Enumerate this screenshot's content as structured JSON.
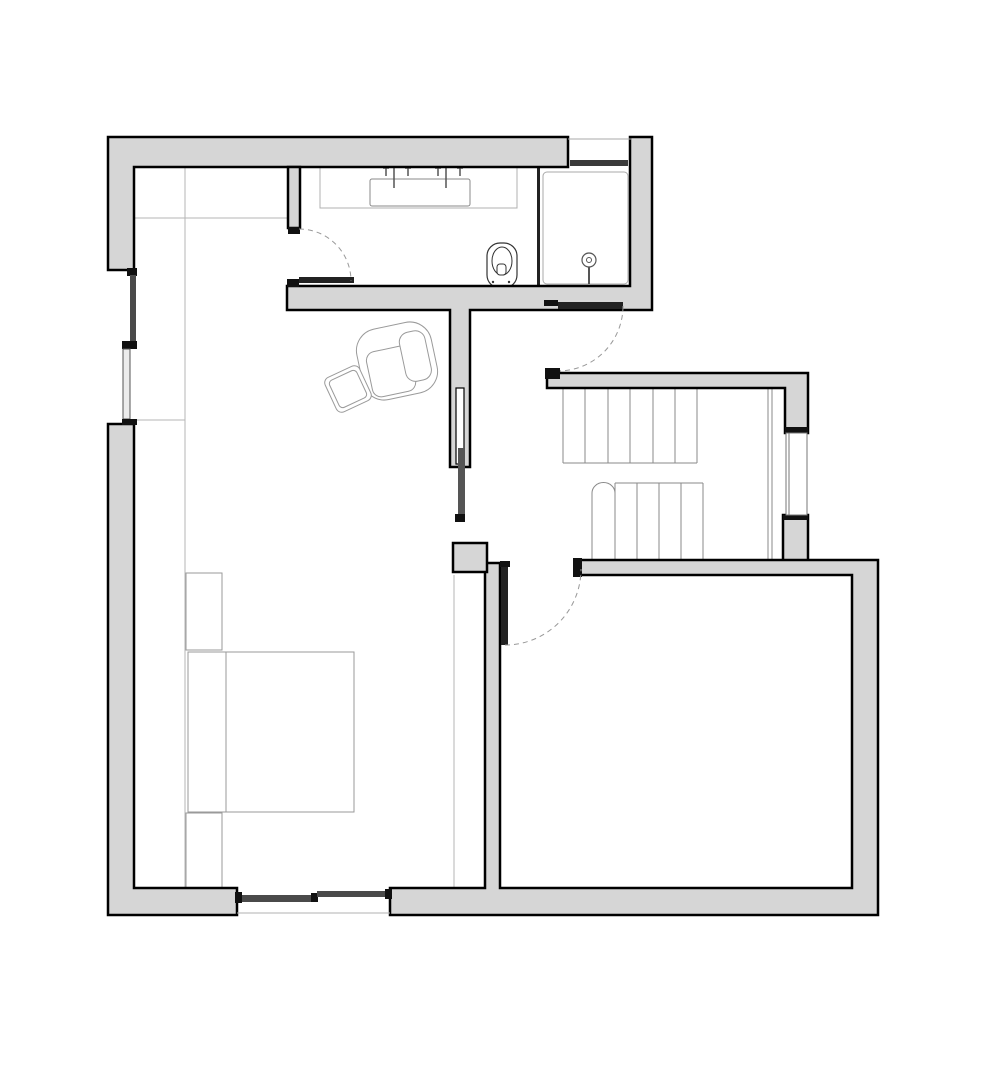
{
  "document": {
    "kind": "architectural-floor-plan",
    "canvas": {
      "width": 1000,
      "height": 1079,
      "background": "#ffffff"
    }
  },
  "colors": {
    "wall_fill": "#d6d6d6",
    "wall_stroke": "#000000",
    "black_detail": "#111111",
    "door_leaf": "#222222",
    "panel_dark": "#4a4a4a",
    "panel_light": "#ececec",
    "fixture_stroke": "#555555",
    "stair_stroke": "#8a8a8a",
    "furniture_stroke": "#9a9a9a",
    "faint_line": "#b5b5b5",
    "arc_dash": "#999999",
    "window_bar": "#3a3a3a"
  },
  "layers": [
    {
      "name": "furniture",
      "items": [
        {
          "type": "line",
          "name": "closet-top-line",
          "x1": 134,
          "y1": 218,
          "x2": 288,
          "y2": 218,
          "stroke": "#b5b5b5",
          "sw": 1
        },
        {
          "type": "line",
          "name": "closet-side-line",
          "x1": 185,
          "y1": 167,
          "x2": 185,
          "y2": 888,
          "stroke": "#b5b5b5",
          "sw": 1
        },
        {
          "type": "line",
          "name": "closet-divider-line",
          "x1": 134,
          "y1": 420,
          "x2": 185,
          "y2": 420,
          "stroke": "#b5b5b5",
          "sw": 1
        },
        {
          "type": "line",
          "name": "wardrobe-edge-line",
          "x1": 454,
          "y1": 575,
          "x2": 454,
          "y2": 888,
          "stroke": "#b5b5b5",
          "sw": 1
        },
        {
          "type": "rect",
          "name": "vanity-counter",
          "x": 320,
          "y": 166,
          "w": 197,
          "h": 42,
          "fill": "none",
          "stroke": "#b0b0b0",
          "sw": 1
        },
        {
          "type": "rect",
          "name": "nightstand-top",
          "x": 186,
          "y": 573,
          "w": 36,
          "h": 77,
          "fill": "#ffffff",
          "stroke": "#9a9a9a",
          "sw": 1
        },
        {
          "type": "rect",
          "name": "nightstand-bottom",
          "x": 186,
          "y": 813,
          "w": 36,
          "h": 75,
          "fill": "#ffffff",
          "stroke": "#9a9a9a",
          "sw": 1
        },
        {
          "type": "rect",
          "name": "bed",
          "x": 188,
          "y": 652,
          "w": 166,
          "h": 160,
          "fill": "#ffffff",
          "stroke": "#9a9a9a",
          "sw": 1
        },
        {
          "type": "line",
          "name": "bed-headboard-line",
          "x1": 226,
          "y1": 652,
          "x2": 226,
          "y2": 812,
          "stroke": "#9a9a9a",
          "sw": 1
        },
        {
          "type": "group",
          "name": "armchair",
          "transform": "translate(397,361) rotate(-12)",
          "items": [
            {
              "type": "rect",
              "name": "armchair-shell",
              "x": -38,
              "y": -36,
              "w": 76,
              "h": 72,
              "rx": 22,
              "fill": "#ffffff",
              "stroke": "#9a9a9a",
              "sw": 1
            },
            {
              "type": "rect",
              "name": "armchair-seat",
              "x": -30,
              "y": -14,
              "w": 44,
              "h": 46,
              "rx": 9,
              "fill": "#ffffff",
              "stroke": "#9a9a9a",
              "sw": 1
            },
            {
              "type": "rect",
              "name": "armchair-back",
              "x": 6,
              "y": -26,
              "w": 26,
              "h": 50,
              "rx": 10,
              "fill": "#ffffff",
              "stroke": "#9a9a9a",
              "sw": 1
            }
          ]
        },
        {
          "type": "group",
          "name": "ottoman",
          "transform": "translate(348,389) rotate(-25)",
          "items": [
            {
              "type": "rect",
              "name": "ottoman-outer",
              "x": -19,
              "y": -19,
              "w": 38,
              "h": 38,
              "rx": 6,
              "fill": "#ffffff",
              "stroke": "#9a9a9a",
              "sw": 1
            },
            {
              "type": "rect",
              "name": "ottoman-inner",
              "x": -15,
              "y": -15,
              "w": 30,
              "h": 30,
              "rx": 4,
              "fill": "none",
              "stroke": "#9a9a9a",
              "sw": 1
            }
          ]
        }
      ]
    },
    {
      "name": "fixtures",
      "items": [
        {
          "type": "rect",
          "name": "sink-basin",
          "x": 370,
          "y": 179,
          "w": 100,
          "h": 27,
          "rx": 2,
          "fill": "#ffffff",
          "stroke": "#888888",
          "sw": 1
        },
        {
          "type": "path",
          "name": "faucet-left",
          "d": "M383,168 h6 M386,168 v8 M405,168 h6 M408,168 v8 M394,167 v21",
          "stroke": "#555555",
          "sw": 1.5,
          "fill": "none"
        },
        {
          "type": "path",
          "name": "faucet-right",
          "d": "M435,168 h6 M438,168 v8 M457,168 h6 M460,168 v8 M446,167 v21",
          "stroke": "#555555",
          "sw": 1.5,
          "fill": "none"
        },
        {
          "type": "rect",
          "name": "toilet-bowl",
          "x": 487,
          "y": 243,
          "w": 30,
          "h": 45,
          "rx": 13,
          "fill": "#ffffff",
          "stroke": "#333333",
          "sw": 1.2
        },
        {
          "type": "ellipse",
          "name": "toilet-seat",
          "cx": 502,
          "cy": 261,
          "rx": 10,
          "ry": 14,
          "fill": "none",
          "stroke": "#333333",
          "sw": 1
        },
        {
          "type": "rect",
          "name": "toilet-flush",
          "x": 497,
          "y": 264,
          "w": 9,
          "h": 11,
          "rx": 3,
          "fill": "#ffffff",
          "stroke": "#333333",
          "sw": 1
        },
        {
          "type": "circle",
          "name": "toilet-bolt-left",
          "cx": 493,
          "cy": 282,
          "r": 1.2,
          "fill": "#333333"
        },
        {
          "type": "circle",
          "name": "toilet-bolt-right",
          "cx": 509,
          "cy": 282,
          "r": 1.2,
          "fill": "#333333"
        },
        {
          "type": "rect",
          "name": "shower-tray",
          "x": 543,
          "y": 172,
          "w": 85,
          "h": 112,
          "rx": 4,
          "fill": "#ffffff",
          "stroke": "#aaaaaa",
          "sw": 1
        },
        {
          "type": "rect",
          "name": "shower-glass-panel",
          "x": 537,
          "y": 167,
          "w": 3,
          "h": 122,
          "fill": "#222222"
        },
        {
          "type": "circle",
          "name": "shower-head-outer",
          "cx": 589,
          "cy": 260,
          "r": 7,
          "fill": "none",
          "stroke": "#555555",
          "sw": 1.2
        },
        {
          "type": "circle",
          "name": "shower-head-inner",
          "cx": 589,
          "cy": 260,
          "r": 2.5,
          "fill": "none",
          "stroke": "#555555",
          "sw": 1
        },
        {
          "type": "line",
          "name": "shower-head-arm",
          "x1": 589,
          "y1": 267,
          "x2": 589,
          "y2": 284,
          "stroke": "#555555",
          "sw": 2
        }
      ]
    },
    {
      "name": "stairs",
      "items": [
        {
          "type": "path",
          "name": "stair-upper-treads",
          "d": "M563,388 V463 M585,388 V463 M608,388 V463 M630,388 V463 M653,388 V463 M675,388 V463 M697,388 V463 M563,463 H697",
          "stroke": "#8a8a8a",
          "sw": 1,
          "fill": "none"
        },
        {
          "type": "path",
          "name": "stair-rail",
          "d": "M768,388 V560 M772,388 V560",
          "stroke": "#8a8a8a",
          "sw": 1,
          "fill": "none"
        },
        {
          "type": "path",
          "name": "stair-lower-treads",
          "d": "M615,483 V560 M637,483 V560 M659,483 V560 M681,483 V560 M703,483 V560 M615,483 H703 M592,493 V560",
          "stroke": "#8a8a8a",
          "sw": 1,
          "fill": "none"
        },
        {
          "type": "path",
          "name": "stair-bullnose-step",
          "d": "M592,493 A11.5,10.5 0 0 1 615,493",
          "stroke": "#8a8a8a",
          "sw": 1,
          "fill": "none"
        }
      ]
    },
    {
      "name": "walls",
      "items": [
        {
          "type": "path",
          "name": "wall-top-left",
          "d": "M108,137 H568 V167 H134 V270 H108 Z",
          "fill": "#d6d6d6",
          "stroke": "#000000",
          "sw": 2.5
        },
        {
          "type": "path",
          "name": "wall-lower-left",
          "d": "M108,424 H134 V888 H237 V915 H108 Z",
          "fill": "#d6d6d6",
          "stroke": "#000000",
          "sw": 2.5
        },
        {
          "type": "path",
          "name": "wall-bath-right-bottom",
          "d": "M630,137 H652 V310 H470 V467 H450 V310 H287 V286 H630 Z",
          "fill": "#d6d6d6",
          "stroke": "#000000",
          "sw": 2.5
        },
        {
          "type": "rect",
          "name": "wall-partition-stub",
          "x": 288,
          "y": 167,
          "w": 12,
          "h": 61,
          "fill": "#d6d6d6",
          "stroke": "#000000",
          "sw": 2.5
        },
        {
          "type": "path",
          "name": "wall-stair-top",
          "d": "M547,373 H808 V433 H785 V388 H547 Z",
          "fill": "#d6d6d6",
          "stroke": "#000000",
          "sw": 2.5
        },
        {
          "type": "rect",
          "name": "wall-stair-right-lower",
          "x": 783,
          "y": 515,
          "w": 25,
          "h": 47,
          "fill": "#d6d6d6",
          "stroke": "#000000",
          "sw": 2.5
        },
        {
          "type": "path",
          "name": "wall-right-room",
          "d": "M575,560 H878 V915 H390 V888 H485 V563 H500 V888 H852 V575 H575 Z",
          "fill": "#d6d6d6",
          "stroke": "#000000",
          "sw": 2.5
        },
        {
          "type": "rect",
          "name": "wall-divider-block",
          "x": 453,
          "y": 543,
          "w": 34,
          "h": 29,
          "fill": "#d6d6d6",
          "stroke": "#000000",
          "sw": 2.5
        }
      ]
    },
    {
      "name": "openings",
      "items": [
        {
          "type": "rect",
          "name": "pocket-door-slot",
          "x": 456,
          "y": 388,
          "w": 8,
          "h": 76,
          "fill": "#ffffff",
          "stroke": "#000000",
          "sw": 1.2
        },
        {
          "type": "rect",
          "name": "pocket-door-leaf",
          "x": 458,
          "y": 448,
          "w": 7,
          "h": 68,
          "fill": "#555555"
        },
        {
          "type": "rect",
          "name": "pocket-door-end-cap",
          "x": 455,
          "y": 514,
          "w": 10,
          "h": 8,
          "fill": "#111111"
        },
        {
          "type": "rect",
          "name": "partition-end-cap",
          "x": 288,
          "y": 227,
          "w": 12,
          "h": 7,
          "fill": "#111111"
        },
        {
          "type": "rect",
          "name": "corridor-door-jamb",
          "x": 287,
          "y": 279,
          "w": 12,
          "h": 8,
          "fill": "#111111"
        },
        {
          "type": "rect",
          "name": "corridor-door-leaf",
          "x": 299,
          "y": 277,
          "w": 55,
          "h": 6,
          "fill": "#222222"
        },
        {
          "type": "path",
          "name": "corridor-door-arc",
          "d": "M299,229 A52,52 0 0 1 351,281",
          "fill": "none",
          "stroke": "#999999",
          "sw": 1,
          "dash": "5 4"
        },
        {
          "type": "rect",
          "name": "bath-door-jamb",
          "x": 544,
          "y": 300,
          "w": 14,
          "h": 6,
          "fill": "#111111"
        },
        {
          "type": "rect",
          "name": "bath-door-leaf",
          "x": 558,
          "y": 302,
          "w": 65,
          "h": 7,
          "fill": "#222222"
        },
        {
          "type": "path",
          "name": "bath-door-arc",
          "d": "M623,306 A65,65 0 0 1 558,371",
          "fill": "none",
          "stroke": "#999999",
          "sw": 1,
          "dash": "5 4"
        },
        {
          "type": "rect",
          "name": "stair-wall-left-cap",
          "x": 545,
          "y": 368,
          "w": 15,
          "h": 11,
          "fill": "#111111"
        },
        {
          "type": "rect",
          "name": "stair-wall-upper-end-cap",
          "x": 785,
          "y": 427,
          "w": 23,
          "h": 6,
          "fill": "#111111"
        },
        {
          "type": "rect",
          "name": "stair-wall-lower-top-cap",
          "x": 783,
          "y": 515,
          "w": 25,
          "h": 5,
          "fill": "#111111"
        },
        {
          "type": "rect",
          "name": "room-wall-left-cap",
          "x": 573,
          "y": 558,
          "w": 9,
          "h": 19,
          "fill": "#111111"
        },
        {
          "type": "rect",
          "name": "landing-door-hinge-cap",
          "x": 500,
          "y": 561,
          "w": 10,
          "h": 6,
          "fill": "#111111"
        },
        {
          "type": "rect",
          "name": "landing-door-leaf",
          "x": 501,
          "y": 567,
          "w": 7,
          "h": 78,
          "fill": "#222222"
        },
        {
          "type": "path",
          "name": "landing-door-arc",
          "d": "M505,645 A76,76 0 0 0 581,569",
          "fill": "none",
          "stroke": "#999999",
          "sw": 1,
          "dash": "5 4"
        },
        {
          "type": "rect",
          "name": "left-window-cap-top",
          "x": 127,
          "y": 268,
          "w": 10,
          "h": 8,
          "fill": "#111111"
        },
        {
          "type": "rect",
          "name": "left-window-panel-1",
          "x": 130,
          "y": 275,
          "w": 6,
          "h": 67,
          "fill": "#4a4a4a"
        },
        {
          "type": "rect",
          "name": "left-window-cap-mid",
          "x": 122,
          "y": 341,
          "w": 15,
          "h": 8,
          "fill": "#111111"
        },
        {
          "type": "rect",
          "name": "left-window-panel-2",
          "x": 123,
          "y": 349,
          "w": 7,
          "h": 70,
          "fill": "#ececec",
          "stroke": "#555555",
          "sw": 1
        },
        {
          "type": "rect",
          "name": "left-window-cap-bottom",
          "x": 122,
          "y": 419,
          "w": 15,
          "h": 6,
          "fill": "#111111"
        },
        {
          "type": "path",
          "name": "top-window-outer-line",
          "d": "M568,139 H632",
          "fill": "none",
          "stroke": "#aaaaaa",
          "sw": 1
        },
        {
          "type": "rect",
          "name": "top-window-bar",
          "x": 570,
          "y": 160,
          "w": 58,
          "h": 6,
          "fill": "#3a3a3a"
        },
        {
          "type": "rect",
          "name": "stair-window",
          "x": 786,
          "y": 433,
          "w": 21,
          "h": 82,
          "fill": "#ffffff",
          "stroke": "#777777",
          "sw": 1
        },
        {
          "type": "path",
          "name": "stair-window-glazing",
          "d": "M789,433 V515",
          "fill": "none",
          "stroke": "#777777",
          "sw": 1
        },
        {
          "type": "rect",
          "name": "patio-door-jamb-left",
          "x": 235,
          "y": 892,
          "w": 7,
          "h": 11,
          "fill": "#111111"
        },
        {
          "type": "rect",
          "name": "patio-door-panel-a",
          "x": 242,
          "y": 895,
          "w": 70,
          "h": 7,
          "fill": "#4a4a4a"
        },
        {
          "type": "rect",
          "name": "patio-door-joint",
          "x": 311,
          "y": 893,
          "w": 7,
          "h": 9,
          "fill": "#111111"
        },
        {
          "type": "rect",
          "name": "patio-door-panel-b",
          "x": 317,
          "y": 891,
          "w": 69,
          "h": 6,
          "fill": "#4a4a4a"
        },
        {
          "type": "rect",
          "name": "patio-door-jamb-right",
          "x": 385,
          "y": 889,
          "w": 7,
          "h": 10,
          "fill": "#111111"
        },
        {
          "type": "path",
          "name": "patio-door-outer-line",
          "d": "M237,913 H390",
          "fill": "none",
          "stroke": "#b0b0b0",
          "sw": 1
        }
      ]
    }
  ]
}
